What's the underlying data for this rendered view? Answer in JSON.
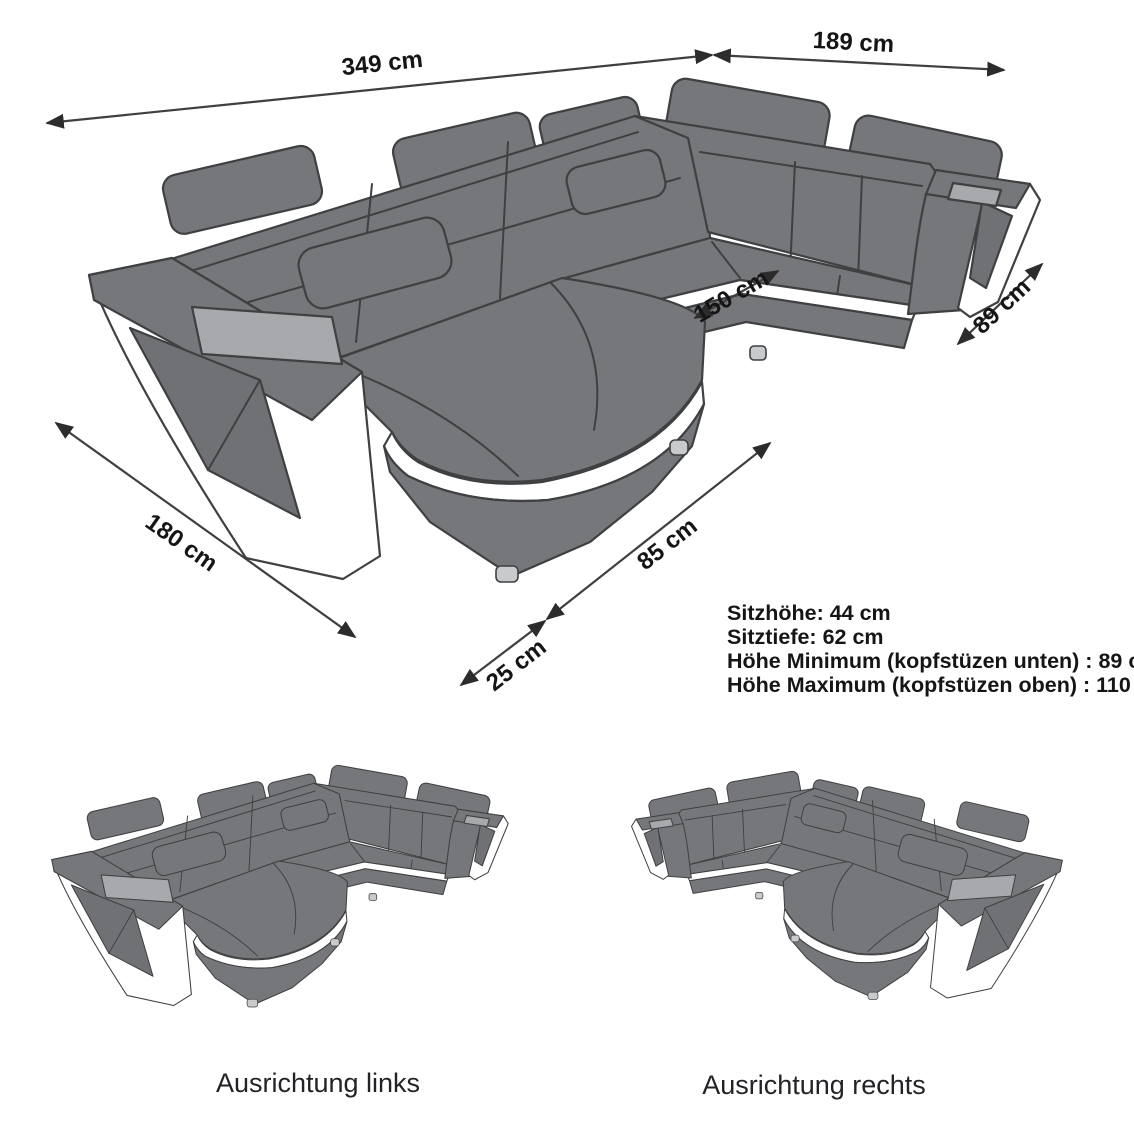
{
  "page": {
    "background": "#ffffff"
  },
  "main_diagram": {
    "dimension_labels": {
      "total_width": "349 cm",
      "right_depth": "189 cm",
      "inner_width": "150 cm",
      "right_arm_depth": "89 cm",
      "left_depth": "180 cm",
      "front_foot": "25 cm",
      "chaise_front": "85 cm"
    },
    "specs": [
      "Sitzhöhe: 44 cm",
      "Sitztiefe: 62 cm",
      "Höhe Minimum (kopfstüzen unten) : 89 cm",
      "Höhe Maximum (kopfstüzen oben) : 110 cm"
    ]
  },
  "variants": [
    {
      "label": "Ausrichtung links"
    },
    {
      "label": "Ausrichtung rechts"
    }
  ],
  "colors": {
    "sofa_body": "#75777a",
    "sofa_panel": "#6f7174",
    "sofa_outline": "#3e4042",
    "accent_white": "#ffffff",
    "tray_gray": "#a7a9ac",
    "feet_gray": "#c8cacc",
    "dimension_line": "#3f3f3f",
    "text": "#151515"
  }
}
